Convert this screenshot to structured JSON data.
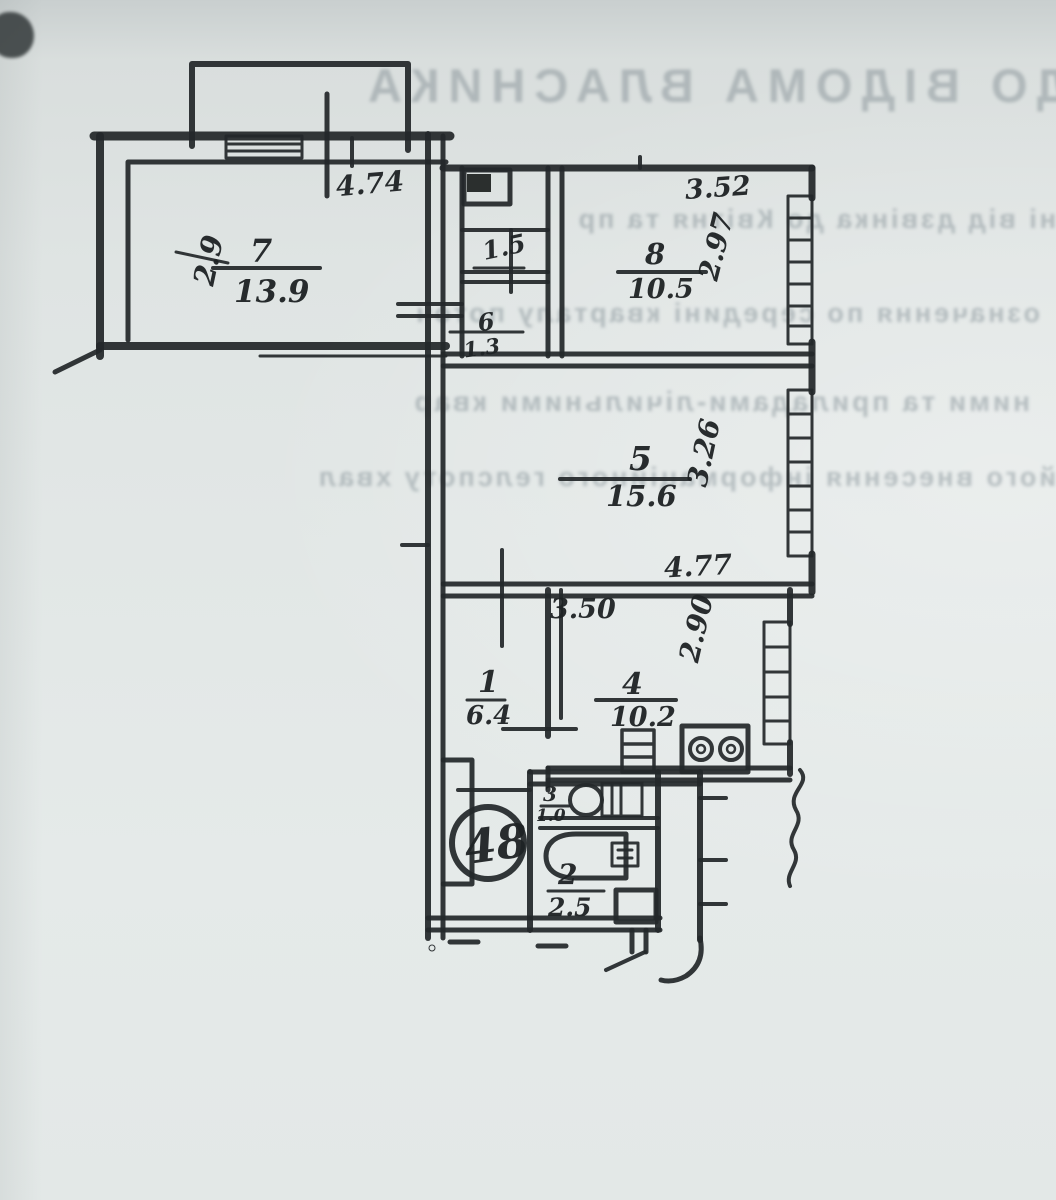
{
  "bleed_through": {
    "heading_mirrored": "ДО ВІДОМА ВЛАСНИКА",
    "line_fragments_mirrored": [
      "ні від дзвінка до Квітня та пр",
      "означення по середині кварталу поточ",
      "ними та приладами-лічильними квар",
      "його внесення інформаційного гелспоту хвал"
    ]
  },
  "plan": {
    "apartment_number": "48",
    "rooms": {
      "r7": {
        "num": "7",
        "area": "13.9"
      },
      "r8": {
        "num": "8",
        "area": "10.5"
      },
      "r5": {
        "num": "5",
        "area": "15.6"
      },
      "r1": {
        "num": "1",
        "area": "6.4"
      },
      "r4": {
        "num": "4",
        "area": "10.2"
      },
      "r6": {
        "num": "6",
        "area": "1.3"
      },
      "r3": {
        "num": "3",
        "area": "1.0"
      },
      "r2": {
        "num": "2",
        "area": "2.5"
      },
      "closet": {
        "area": "1.5"
      }
    },
    "dims": {
      "balcony_w": "4.74",
      "r7_d": "2.9",
      "r8_w": "3.52",
      "r8_d": "2.97",
      "r5_d": "3.26",
      "r5_w": "4.77",
      "r4_w": "3.50",
      "r4_d": "2.90"
    }
  }
}
